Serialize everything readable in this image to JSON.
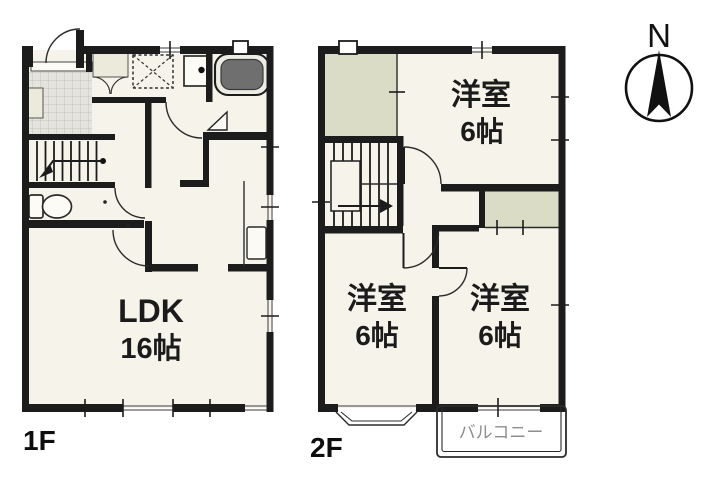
{
  "floors": {
    "f1": {
      "label": "1F",
      "ldk": {
        "name": "LDK",
        "size": "16帖"
      }
    },
    "f2": {
      "label": "2F",
      "bedrooms": [
        {
          "name": "洋室",
          "size": "6帖"
        },
        {
          "name": "洋室",
          "size": "6帖"
        },
        {
          "name": "洋室",
          "size": "6帖"
        }
      ],
      "balcony": {
        "label": "バルコニー"
      }
    }
  },
  "compass": {
    "north": "N"
  },
  "colors": {
    "wall": "#1c1c1c",
    "floor": "#f6f3ea",
    "closet": "#dadcc6",
    "tile": "#e4e3dd",
    "bathtub": "#6f6f6f",
    "balcony_text": "#8d8d8d"
  }
}
